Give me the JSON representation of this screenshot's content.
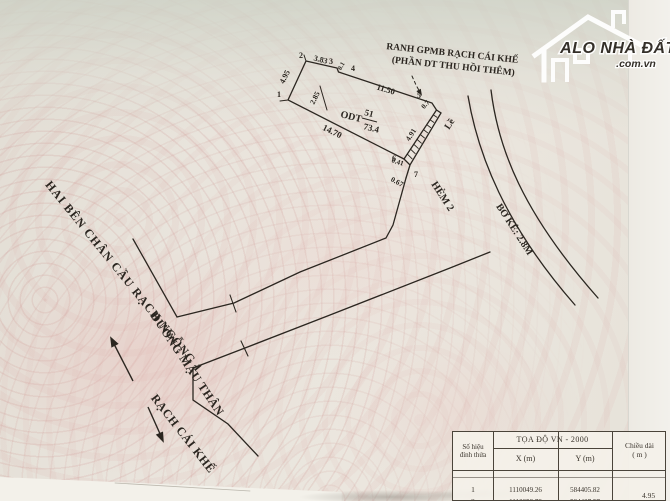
{
  "watermark": {
    "brand": "ALO NHÀ ĐẤT",
    "domain": ".com.vn"
  },
  "boundary_note": {
    "line1": "RANH GPMB RẠCH CÁI KHẾ",
    "line2": "(PHẦN DT THU HỒI THÊM)"
  },
  "parcel": {
    "code": "ODT",
    "number": "51",
    "area": "73.4",
    "sidewalk_label": "Lề",
    "vertices": [
      "1",
      "2",
      "3",
      "4",
      "5",
      "6",
      "7"
    ],
    "dims": {
      "v1_v2": "4.95",
      "v2_v3": "3.83",
      "v3_v4": "0.1",
      "v4_v5": "11.50",
      "v5_a": "0.7",
      "sidewalk": "4.91",
      "v6_v7": "0.41",
      "v7_out": "0.67",
      "v1_v6": "14.70",
      "inner": "2.85"
    }
  },
  "street_labels": {
    "bridge": "HAI BÊN CHÂN CẦU RẠCH NGỖNG 1",
    "street": "ĐƯỜNG MẬU THÂN",
    "canal": "RẠCH CÁI KHẾ",
    "alley": "HẺM 2",
    "embankment": "BỜ KÈ: 2.8M"
  },
  "coord_table": {
    "title": "TỌA ĐỘ  VN - 2000",
    "col_vertex_line1": "Số hiệu",
    "col_vertex_line2": "đỉnh thửa",
    "col_x": "X (m)",
    "col_y": "Y (m)",
    "col_len_line1": "Chiều dài",
    "col_len_line2": "( m )",
    "rows": [
      {
        "id": "1",
        "x": "1110049.26",
        "y": "584405.82"
      },
      {
        "id": "2",
        "x": "1110053.78",
        "y": "584407.57"
      }
    ],
    "edge_length": "4.95"
  },
  "colors": {
    "brand_cyan": "#3cc6dd",
    "ink": "#2b2620",
    "pink": "#e8c6c2"
  }
}
